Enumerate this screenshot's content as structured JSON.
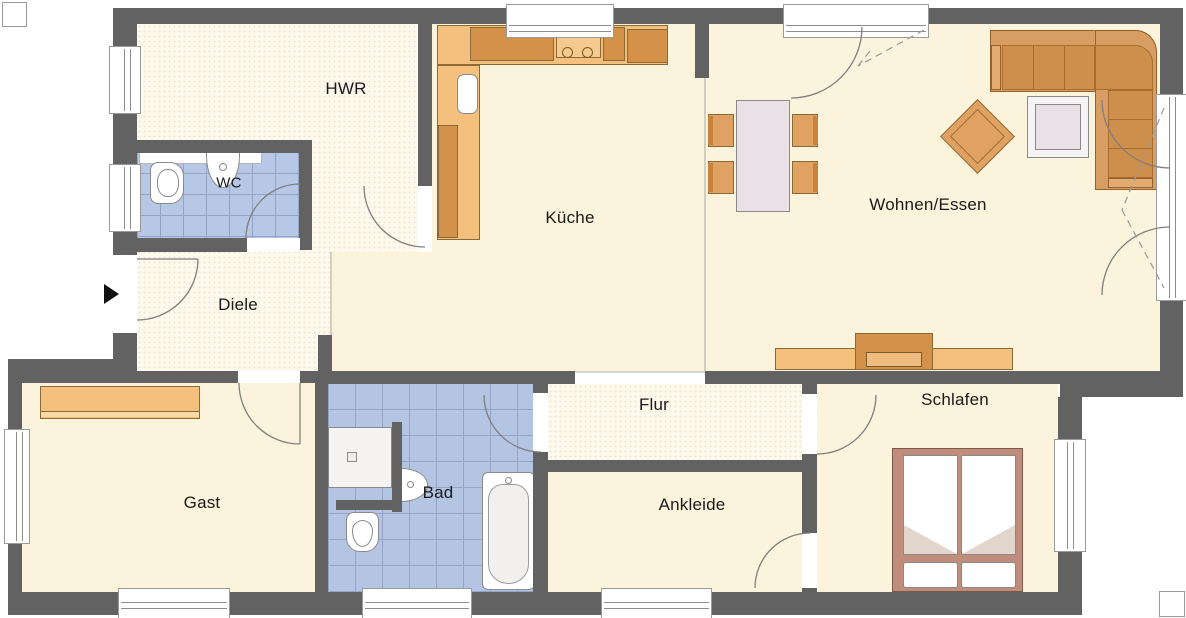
{
  "plan": {
    "type": "floorplan",
    "rooms": {
      "hwr": {
        "label": "HWR"
      },
      "wc": {
        "label": "WC"
      },
      "kueche": {
        "label": "Küche"
      },
      "wohnen_essen": {
        "label": "Wohnen/Essen"
      },
      "diele": {
        "label": "Diele"
      },
      "gast": {
        "label": "Gast"
      },
      "bad": {
        "label": "Bad"
      },
      "flur": {
        "label": "Flur"
      },
      "ankleide": {
        "label": "Ankleide"
      },
      "schlafen": {
        "label": "Schlafen"
      }
    },
    "colors": {
      "wall": "#626262",
      "floor": "#fbf3dc",
      "floor_light": "#fdf9ec",
      "tile_blue": "#b5c5e4",
      "tile_grout": "#94a3c6",
      "furniture_light": "#f3c07e",
      "furniture_mid": "#dfa263",
      "furniture_dark": "#d3914a",
      "sofa_body": "#d89d62",
      "sofa_cushion": "#cf8f4c",
      "table_top": "#e9e1e5",
      "bed_frame": "#c08d7c",
      "fixture_white": "#ffffff",
      "outline_grey": "#8a8a8a",
      "entrance_marker": "#111111"
    },
    "fixtures": [
      "kitchen-counter",
      "stove",
      "fridge",
      "kitchen-sink",
      "dining-table",
      "dining-chairs",
      "corner-sofa",
      "coffee-table",
      "armchair",
      "tv-sideboard",
      "sideboard-gast",
      "shower",
      "bathtub",
      "toilet",
      "washbasin",
      "double-bed",
      "pillows",
      "entrance-arrow"
    ]
  }
}
